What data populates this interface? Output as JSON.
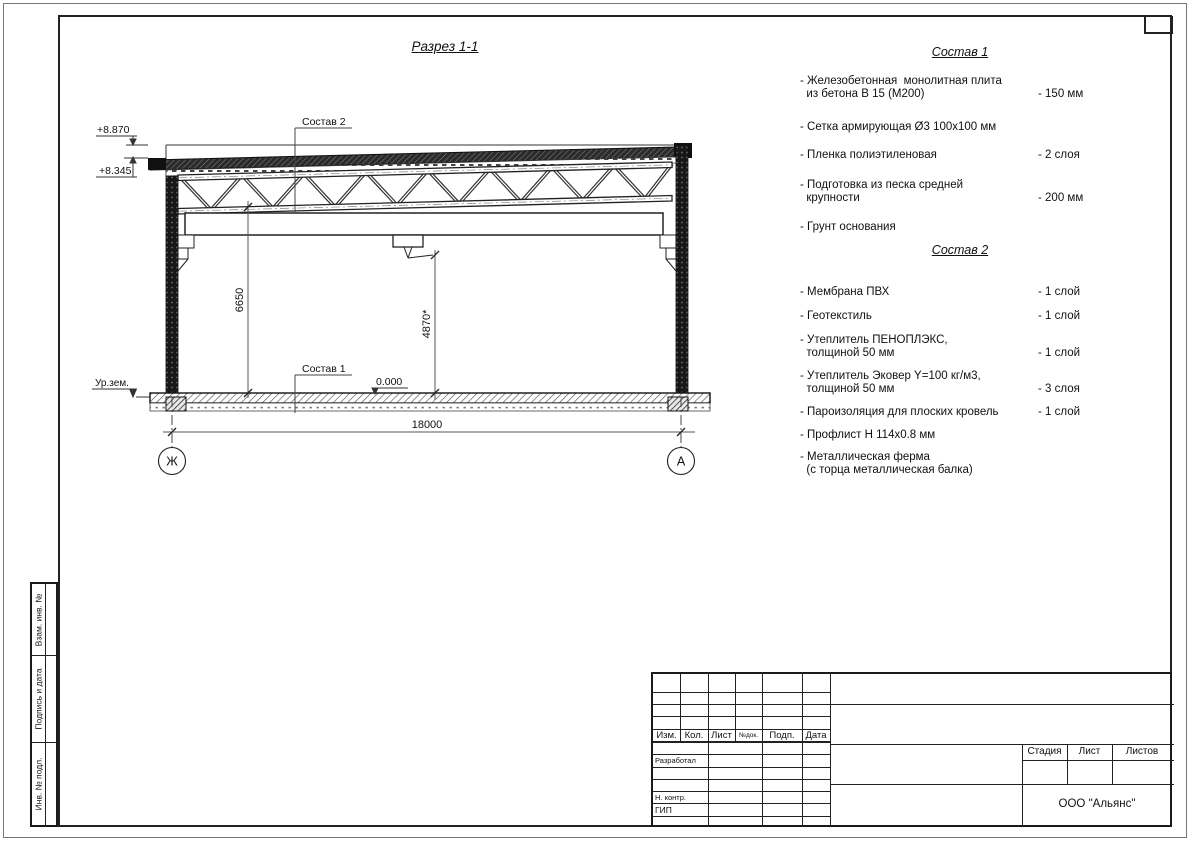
{
  "drawing_title": "Разрез 1-1",
  "sostav1": {
    "title": "Состав 1",
    "items": [
      {
        "name": "- Железобетонная  монолитная плита\n  из бетона В 15 (М200)",
        "value": "- 150 мм"
      },
      {
        "name": "- Сетка армирующая Ø3 100х100 мм"
      },
      {
        "name": "- Пленка полиэтиленовая",
        "value": "- 2 слоя"
      },
      {
        "name": "- Подготовка из песка средней\n  крупности",
        "value": "- 200 мм"
      },
      {
        "name": "- Грунт основания"
      }
    ]
  },
  "sostav2": {
    "title": "Состав 2",
    "items": [
      {
        "name": "- Мембрана ПВХ",
        "value": "- 1 слой"
      },
      {
        "name": "- Геотекстиль",
        "value": "- 1 слой"
      },
      {
        "name": "- Утеплитель ПЕНОПЛЭКС,\n  толщиной 50 мм",
        "value": "- 1 слой"
      },
      {
        "name": "- Утеплитель Эковер Y=100 кг/м3,\n  толщиной 50 мм",
        "value": "- 3 слоя"
      },
      {
        "name": "- Пароизоляция для плоских кровель",
        "value": "- 1 слой"
      },
      {
        "name": "- Профлист Н 114х0.8 мм"
      },
      {
        "name": "- Металлическая ферма\n  (с торца металлическая балка)"
      }
    ]
  },
  "section": {
    "labels": {
      "sostav2_ref": "Состав 2",
      "sostav1_ref": "Состав 1",
      "ground": "Ур.зем.",
      "zero_level": "0.000",
      "elev_top": "+8.870",
      "elev_roof": "+8.345",
      "dim_truss_bottom": "6650",
      "dim_clearance": "4870*",
      "dim_span": "18000",
      "axis_left": "Ж",
      "axis_right": "А"
    }
  },
  "title_block": {
    "header_cols": [
      "Изм.",
      "Кол.",
      "Лист",
      "№док.",
      "Подп.",
      "Дата"
    ],
    "roles": [
      "Разработал",
      "Н. контр.",
      "ГИП"
    ],
    "stage_label": "Стадия",
    "sheet_label": "Лист",
    "sheets_label": "Листов",
    "company": "ООО \"Альянс\""
  },
  "side_stamps": [
    "Взам. инв. №",
    "Подпись и дата",
    "Инв. № подл."
  ]
}
